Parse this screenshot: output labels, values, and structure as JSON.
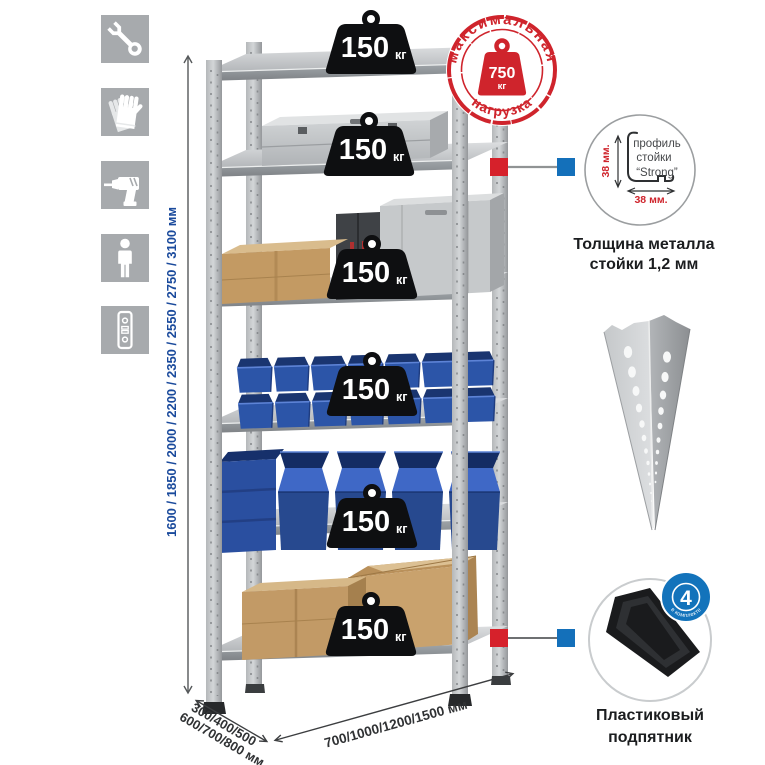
{
  "left_icons": [
    {
      "name": "wrench-icon"
    },
    {
      "name": "gloves-icon"
    },
    {
      "name": "drill-icon"
    },
    {
      "name": "person-icon"
    },
    {
      "name": "rack-post-icon"
    }
  ],
  "dimensions": {
    "height": "1600 / 1850 / 2000 / 2200 / 2350 / 2550 / 2750 / 3100 мм",
    "depth_lines": [
      "300/400/500",
      "600/700/800 мм"
    ],
    "width": "700/1000/1200/1500 мм"
  },
  "shelf_loads": [
    {
      "value": "150",
      "unit": "кг"
    },
    {
      "value": "150",
      "unit": "кг"
    },
    {
      "value": "150",
      "unit": "кг"
    },
    {
      "value": "150",
      "unit": "кг"
    },
    {
      "value": "150",
      "unit": "кг"
    },
    {
      "value": "150",
      "unit": "кг"
    }
  ],
  "stamp": {
    "arc_top": "максимальная",
    "arc_bottom": "нагрузка",
    "value": "750",
    "unit": "кг",
    "color": "#cf242c"
  },
  "profile_detail": {
    "labels": [
      "профиль",
      "стойки",
      "“Strong”"
    ],
    "dim_vertical": "38 мм.",
    "dim_horizontal": "38 мм.",
    "caption_lines": [
      "Толщина металла",
      "стойки 1,2 мм"
    ]
  },
  "foot_detail": {
    "badge_value": "4",
    "badge_arc": "в комплекте",
    "badge_color": "#1373bb",
    "caption_lines": [
      "Пластиковый",
      "подпятник"
    ]
  },
  "colors": {
    "accent_red": "#d6212b",
    "marker_blue": "#1470ba",
    "dim_text_blue": "#1a4a9c",
    "bin_blue": "#2c55a8",
    "metal_light": "#d2d5d7"
  }
}
